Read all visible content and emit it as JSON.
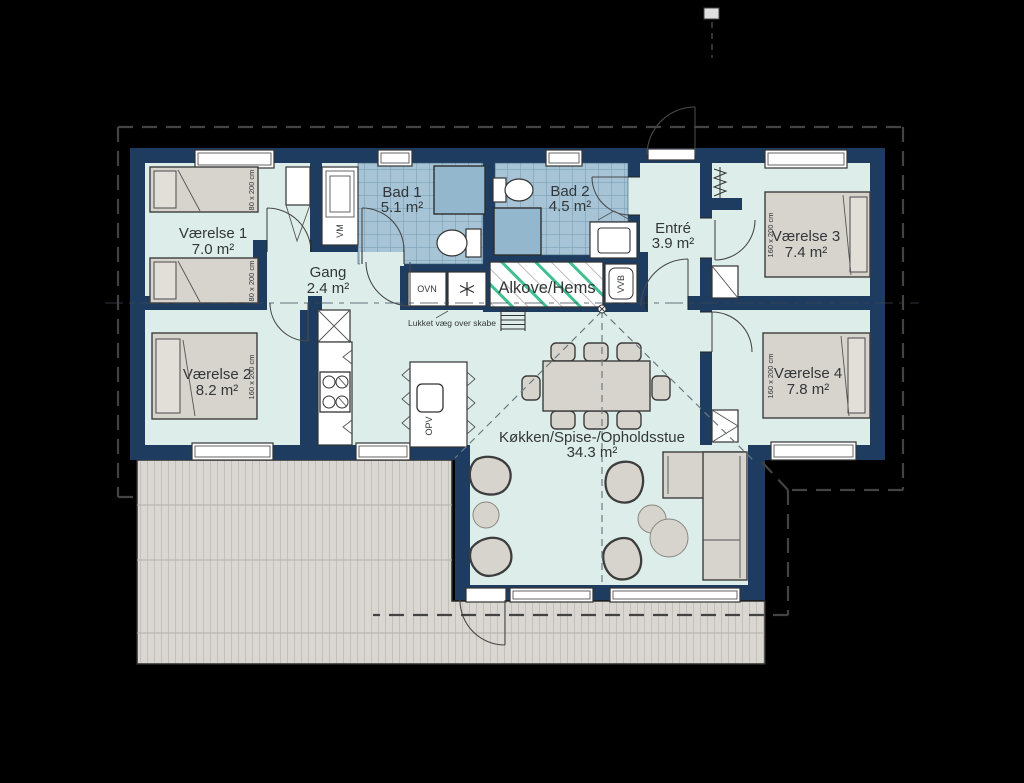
{
  "plan": {
    "rooms": [
      {
        "name": "Værelse 1",
        "area": "7.0 m²"
      },
      {
        "name": "Værelse 2",
        "area": "8.2 m²"
      },
      {
        "name": "Værelse 3",
        "area": "7.4 m²"
      },
      {
        "name": "Værelse 4",
        "area": "7.8 m²"
      },
      {
        "name": "Bad 1",
        "area": "5.1 m²"
      },
      {
        "name": "Bad 2",
        "area": "4.5 m²"
      },
      {
        "name": "Entré",
        "area": "3.9 m²"
      },
      {
        "name": "Gang",
        "area": "2.4 m²"
      },
      {
        "name": "Køkken/Spise-/Opholdsstue",
        "area": "34.3 m²"
      }
    ],
    "alcove_label": "Alkove/Hems",
    "labels": {
      "vm": "VM",
      "ovn": "OVN",
      "opv": "OPV",
      "vvb": "VVB",
      "closed_wall_note": "Lukket væg over skabe",
      "bed_single": "80 x 200 cm",
      "bed_double": "160 x 200 cm"
    },
    "colors": {
      "wall": "#1d3c60",
      "floor": "#ddeeea",
      "bath_tile": "#a6c4d6",
      "tile_grid": "#7397b0",
      "shower": "#93b7cc",
      "furniture": "#d7d4ce",
      "deck": "#dad7d2",
      "alcove_stripe": "#41bf90",
      "background": "#000000"
    }
  }
}
